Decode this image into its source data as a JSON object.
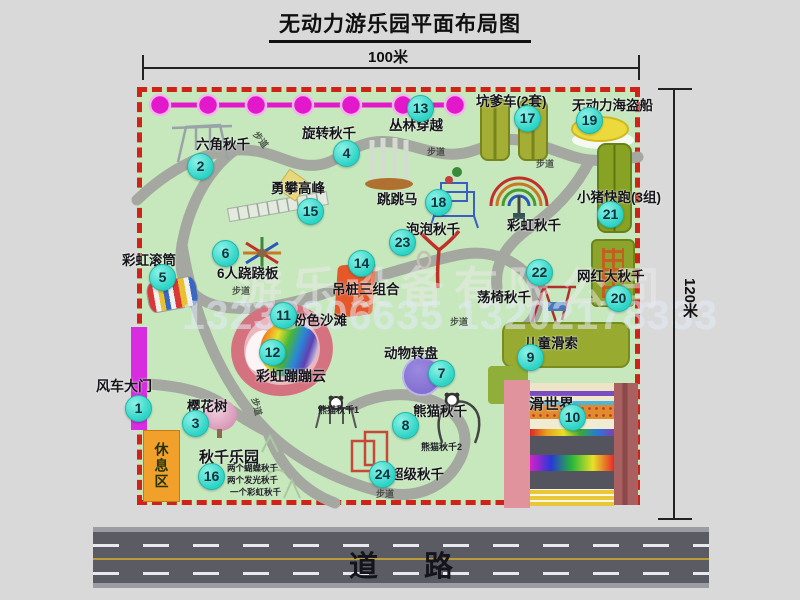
{
  "title": "无动力游乐园平面布局图",
  "dimension_labels": {
    "top": "100米",
    "right": "120米"
  },
  "road": {
    "label": "道路"
  },
  "watermark": {
    "company": "游乐设备有限公司",
    "phone": "13233806635 13202178333"
  },
  "walkway_label": "步道",
  "zones": {
    "rest_area": "休息区"
  },
  "attractions": {
    "windmill_gate": {
      "num": "1",
      "label": "风车大门"
    },
    "hex_swing": {
      "num": "2",
      "label": "六角秋千"
    },
    "cherry_tree": {
      "num": "3",
      "label": "樱花树"
    },
    "rotating_swing": {
      "num": "4",
      "label": "旋转秋千"
    },
    "rainbow_roller": {
      "num": "5",
      "label": "彩虹滚筒"
    },
    "seesaw_6p": {
      "num": "6",
      "label": "6人跷跷板"
    },
    "animal_turntable": {
      "num": "7",
      "label": "动物转盘"
    },
    "panda_swing": {
      "num": "8",
      "label": "熊猫秋千",
      "sub1": "熊猫秋千1",
      "sub2": "熊猫秋千2"
    },
    "kids_zipline": {
      "num": "9",
      "label": "儿童滑索"
    },
    "slide_world": {
      "num": "10",
      "label": "滑世界"
    },
    "pink_beach": {
      "num": "11",
      "label": "粉色沙滩"
    },
    "rainbow_cloud": {
      "num": "12",
      "label": "彩虹蹦蹦云"
    },
    "jungle_crossing": {
      "num": "13",
      "label": "丛林穿越"
    },
    "hanging_piles": {
      "num": "14",
      "label": "吊桩三组合"
    },
    "climb_peak": {
      "num": "15",
      "label": "勇攀高峰"
    },
    "swing_park": {
      "num": "16",
      "label": "秋千乐园",
      "sub1": "两个蝴蝶秋千",
      "sub2": "两个发光秋千",
      "sub3": "一个彩虹秋千"
    },
    "pit_cars": {
      "num": "17",
      "label": "坑爹车(2套)"
    },
    "jumping_horse": {
      "num": "18",
      "label": "跳跳马"
    },
    "pirate_ship": {
      "num": "19",
      "label": "无动力海盗船"
    },
    "big_swing": {
      "num": "20",
      "label": "网红大秋千"
    },
    "piggy_run": {
      "num": "21",
      "label": "小猪快跑(3组)"
    },
    "chair_swing": {
      "num": "22",
      "label": "荡椅秋千"
    },
    "bubble_swing": {
      "num": "23",
      "label": "泡泡秋千"
    },
    "super_swing": {
      "num": "24",
      "label": "超级秋千"
    },
    "rainbow_swing": {
      "label": "彩虹秋千"
    }
  },
  "colors": {
    "map_green": "#c7e7bd",
    "border_red": "#cf2318",
    "badge_cyan": "#2cd4c6",
    "chain_magenta": "#e318cb",
    "gate_magenta": "#d92be0",
    "rest_orange": "#f2a02c",
    "road_gray": "#5b5b64"
  }
}
